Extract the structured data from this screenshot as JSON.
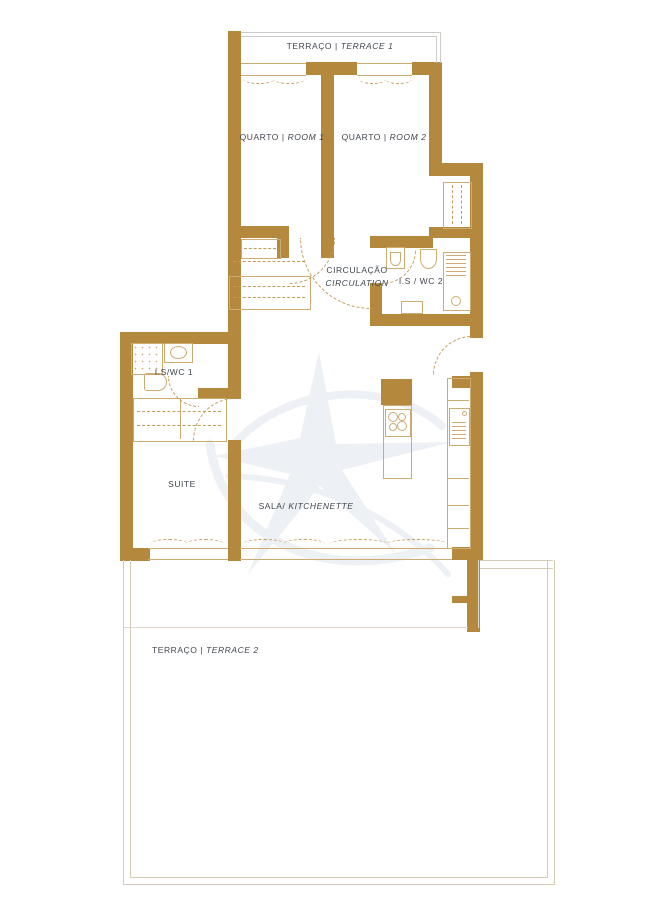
{
  "colors": {
    "wall": "#b5893d",
    "fix": "#cdab72",
    "dash": "#c49a57",
    "sill": "#cdab72",
    "terrace1_line": "#cbcbc7",
    "terrace2_line": "#d6cbb4",
    "step_line": "#e0d8c6",
    "text": "#40474f",
    "watermark": "#dfe5ec",
    "background": "#ffffff"
  },
  "labels": {
    "terrace1": {
      "pt": "TERRAÇO",
      "sep": "|",
      "en": "TERRACE 1"
    },
    "room1": {
      "pt": "QUARTO",
      "sep": "|",
      "en": "ROOM 1"
    },
    "room2": {
      "pt": "QUARTO",
      "sep": "|",
      "en": "ROOM 2"
    },
    "circulation": {
      "pt": "CIRCULAÇÃO",
      "en": "CIRCULATION"
    },
    "wc2": {
      "text": "I.S / WC 2"
    },
    "wc1": {
      "text": "I.S/WC 1"
    },
    "suite": {
      "text": "SUITE"
    },
    "sala": {
      "pt": "SALA/",
      "en": "KITCHENETTE"
    },
    "terrace2": {
      "pt": "TERRAÇO",
      "sep": "|",
      "en": "TERRACE 2"
    }
  }
}
